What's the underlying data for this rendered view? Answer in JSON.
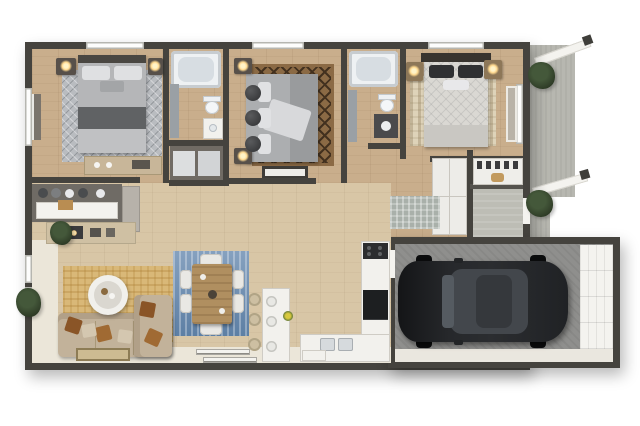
{
  "meta": {
    "kind": "3d-floor-plan-rendering",
    "view": "top-down dollhouse",
    "visible_text": ""
  },
  "rooms": [
    "floor-plan",
    "bedroom-1",
    "bathroom-1",
    "hall-closet",
    "bedroom-2",
    "bathroom-2",
    "bedroom-3",
    "walk-in-closet",
    "hallway",
    "entry",
    "living-room",
    "dining-area",
    "kitchen",
    "garage",
    "patio-walkway"
  ],
  "palette": {
    "wall": "#45433e",
    "floor-wood": "#c9ae8c",
    "floor-living": "#d8c6a6",
    "floor-light": "#ebe6d9",
    "concrete": "#b7b7b0",
    "concrete-in": "#bdbdb5",
    "garage-floor": "#8f8f8d",
    "apron": "#eae7df",
    "white-furn": "#f2f1ed",
    "door-white": "#f4f3ef",
    "rug-gray": "#b9bcc0",
    "rug-brown": "#8b6a45",
    "rug-brown-dark": "#43311f",
    "rug-cream": "#ded3b9",
    "rug-gold": "#d9b878",
    "rug-blue": "#5d7fa4",
    "rug-blue-hi": "#86a1bf",
    "rug-runner": "#a9b0aa",
    "sofa": "#c2b29a",
    "pillow-brown": "#8a5527",
    "pillow-light": "#d4c7b0",
    "bed-gray": "#b5b6b8",
    "bed-dark-stripe": "#606264",
    "bed-quilt": "#dad8d3",
    "pillow-dark": "#2f3032",
    "nightstand": "#57504a",
    "nightstand-warm": "#8d7758",
    "lamp-glow": "#ffd98f",
    "wood-table": "#b08f60",
    "counter-beige": "#cfc0a3",
    "buffet-dark": "#6f6b65",
    "cabinet-gray": "#b7b2aa",
    "plant": "#2e3b26",
    "car-body": "#202225",
    "car-roof": "#43474c",
    "tub": "#eef1f3",
    "tub-inner": "#d7dde2",
    "glass": "#d6dadd",
    "stool": "#cdbfa2"
  }
}
